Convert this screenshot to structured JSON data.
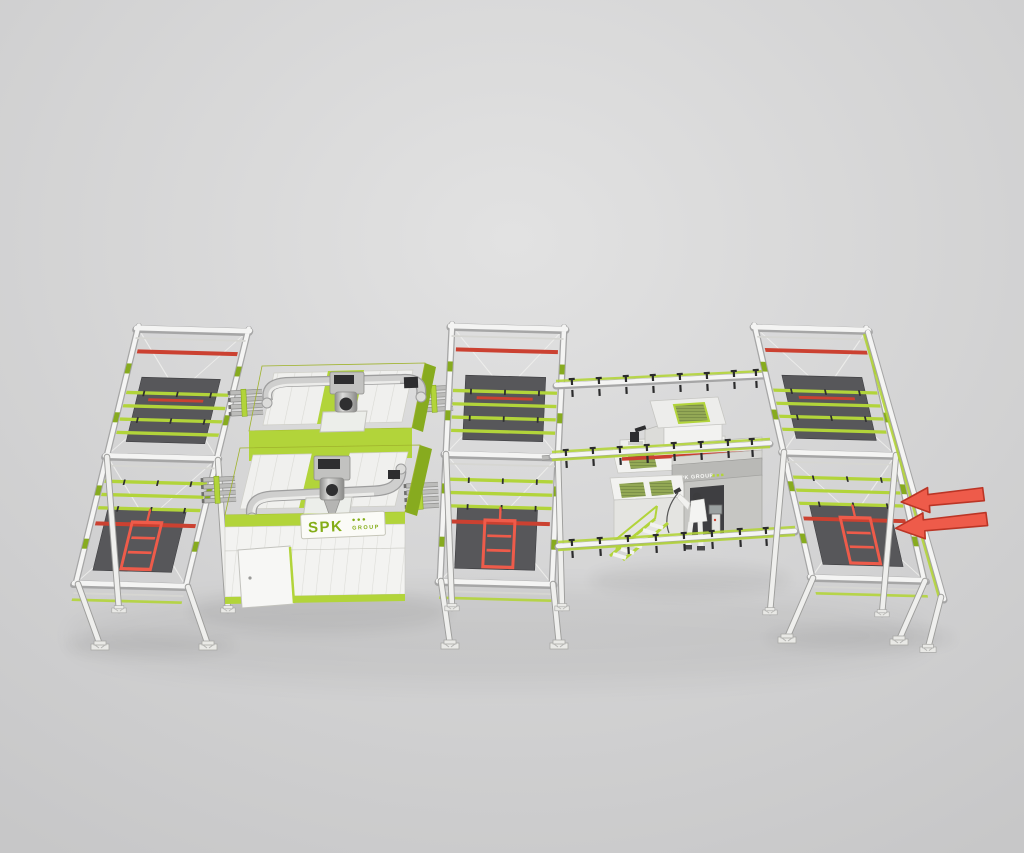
{
  "branding": {
    "machine_plate": {
      "text": "SPK",
      "dots": "●●●",
      "suffix": "GROUP"
    },
    "booth_header": {
      "text": "SPK GROUP",
      "dots": "■ ■ ■"
    }
  },
  "annotations": {
    "flow_arrows": {
      "count": 2,
      "direction": "left"
    }
  },
  "colors": {
    "bg1": "#e2e2e2",
    "bg2": "#c7c7c8",
    "white": "#f4f4f3",
    "frameShadow": "#a6a6a6",
    "lime": "#b2d43a",
    "limeDark": "#87ab1f",
    "limeDeep": "#6f8f1a",
    "red": "#cb4131",
    "redBright": "#ee5b4a",
    "redStroke": "#bb3526",
    "panel": "#57575a"
  }
}
